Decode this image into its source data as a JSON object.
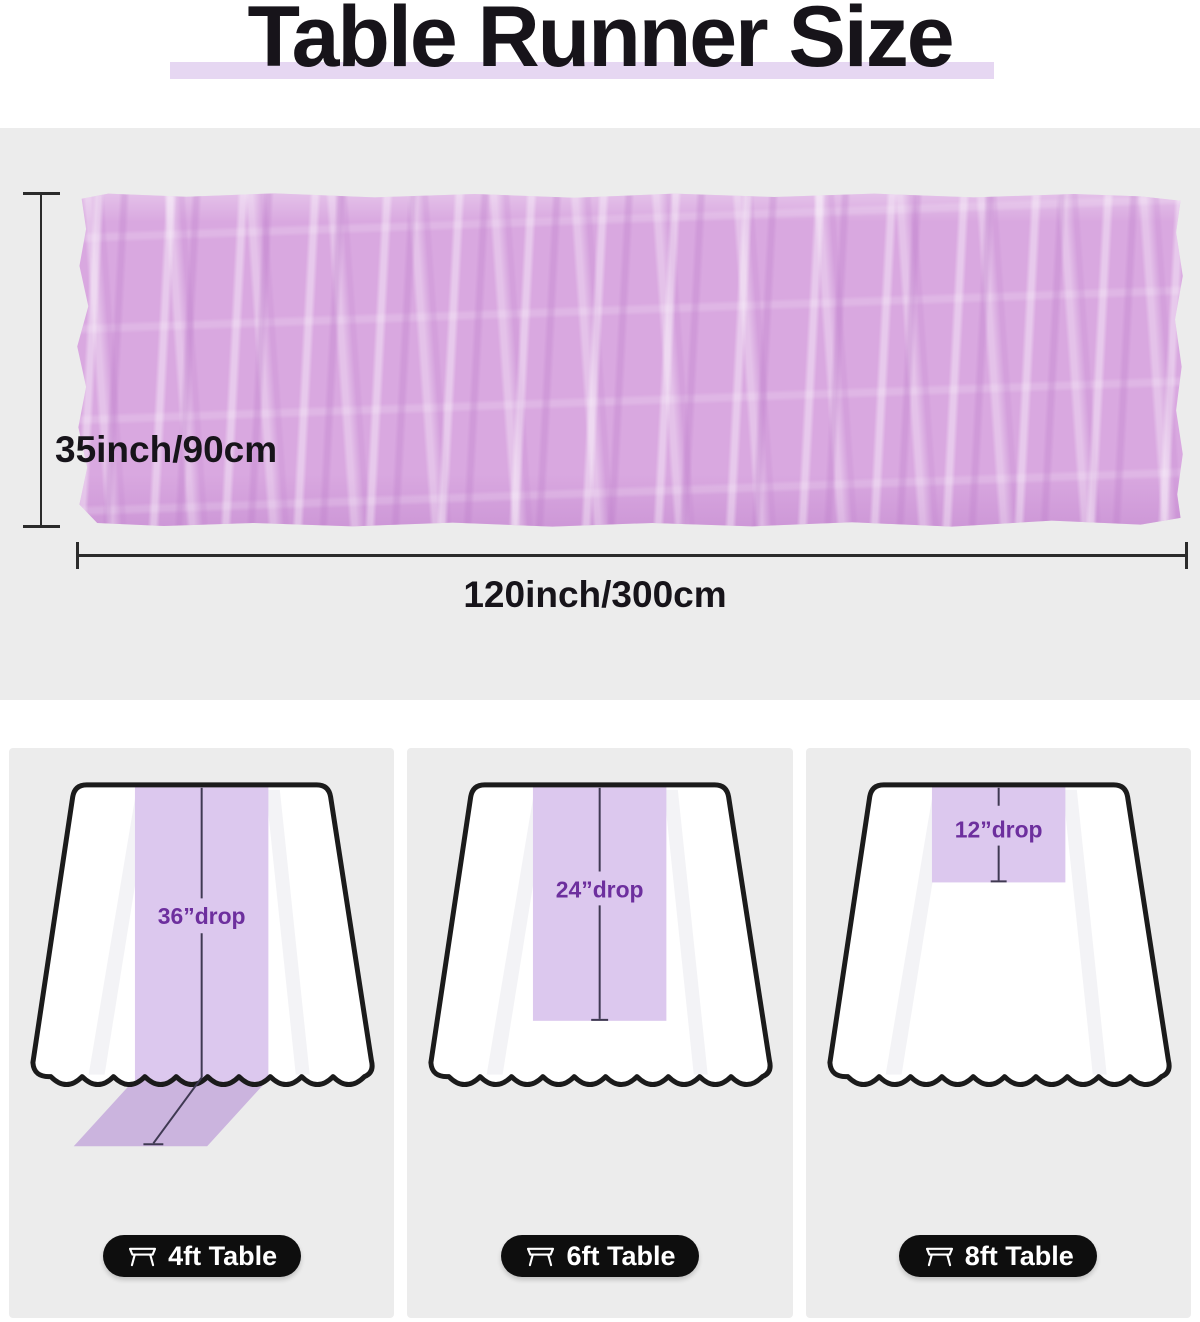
{
  "title": "Table Runner Size",
  "size_diagram": {
    "height_label": "35inch/90cm",
    "width_label": "120inch/300cm"
  },
  "panels": [
    {
      "drop_label": "36”drop",
      "table_label": "4ft Table",
      "icon": "table-icon"
    },
    {
      "drop_label": "24”drop",
      "table_label": "6ft Table",
      "icon": "table-icon"
    },
    {
      "drop_label": "12”drop",
      "table_label": "8ft Table",
      "icon": "table-icon"
    }
  ],
  "colors": {
    "runner_fabric": "#d9a8e0",
    "runner_strip": "#dcc8ee",
    "runner_overhang": "#cbb4de",
    "title_highlight": "#e6d7f2",
    "panel_background": "#ececec",
    "drop_text": "#6d2f9e",
    "pill_background": "#0e0e0e"
  }
}
